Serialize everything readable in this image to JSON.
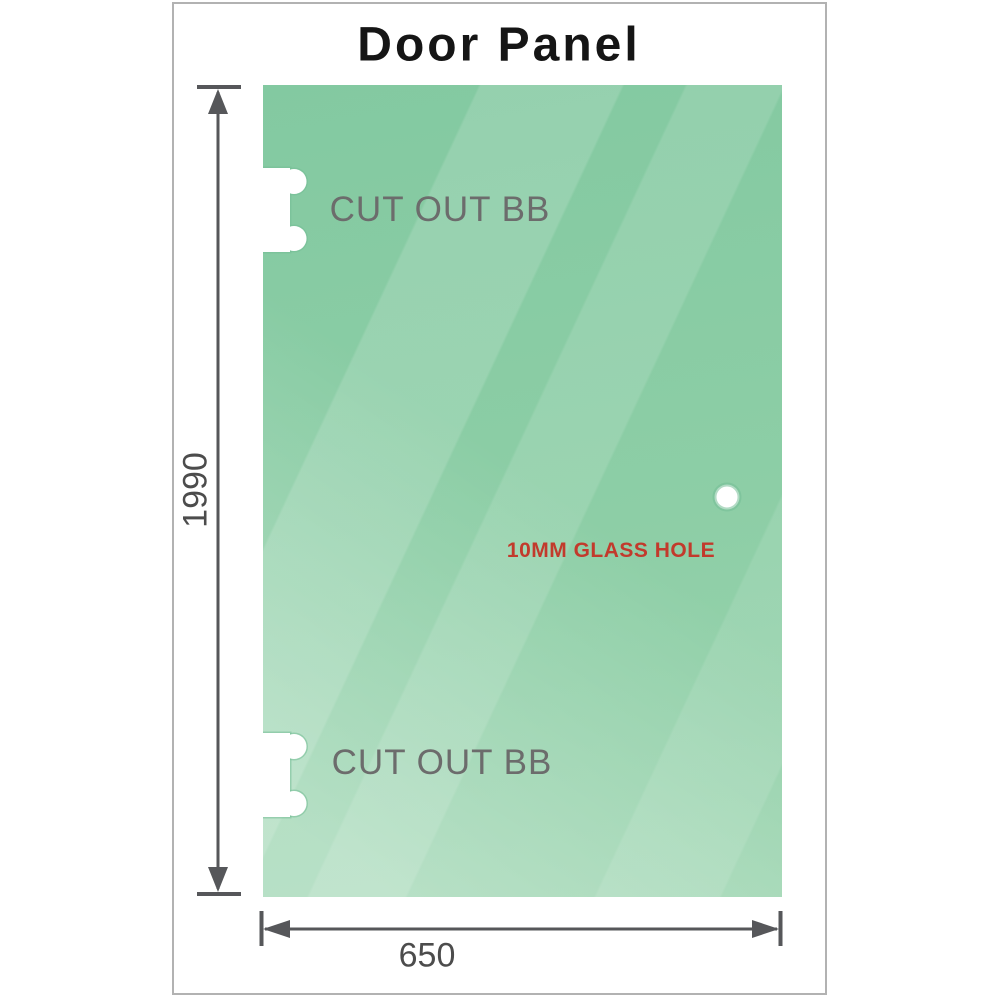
{
  "title": "Door Panel",
  "dimensions": {
    "height_label": "1990",
    "width_label": "650"
  },
  "cutouts": {
    "top_label": "CUT OUT BB",
    "bottom_label": "CUT OUT BB"
  },
  "hole": {
    "label": "10MM GLASS HOLE"
  },
  "icons": {
    "height_dimension": "double-arrow-vertical-icon",
    "width_dimension": "double-arrow-horizontal-icon"
  },
  "colors": {
    "glass_green_base": "#85cba3",
    "glass_green_light": "#c0e5cc",
    "glass_edge_green": "#74bd96",
    "dimension_gray": "#56575a",
    "cutout_label_gray": "#6c6c6c",
    "dim_value_gray": "#4c4c4c",
    "hole_label_red": "#c23a2c",
    "frame_border_gray": "#b2b2b2",
    "title_black": "#151515"
  }
}
